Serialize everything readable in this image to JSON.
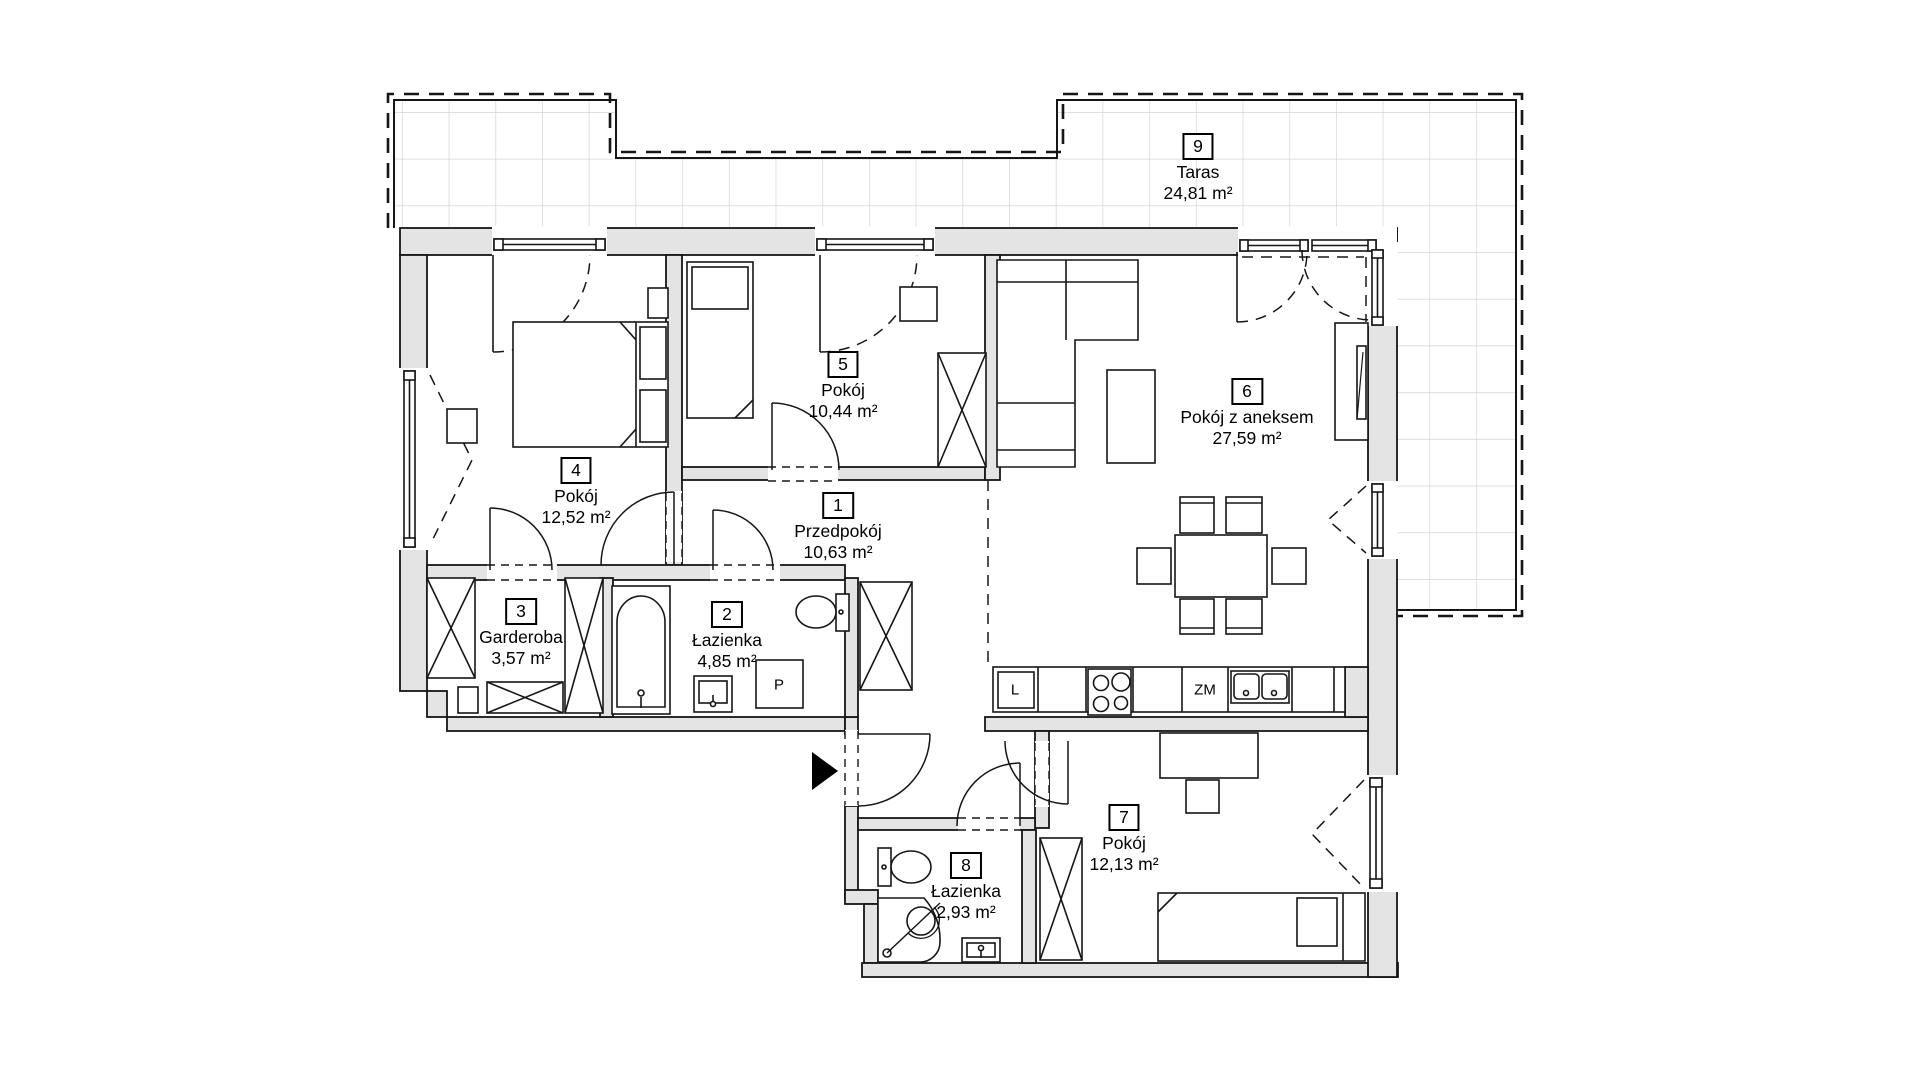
{
  "plan_title": "Rzut mieszkania",
  "rooms": [
    {
      "number": "1",
      "name": "Przedpokój",
      "area": "10,63 m²"
    },
    {
      "number": "2",
      "name": "Łazienka",
      "area": "4,85 m²"
    },
    {
      "number": "3",
      "name": "Garderoba",
      "area": "3,57 m²"
    },
    {
      "number": "4",
      "name": "Pokój",
      "area": "12,52 m²"
    },
    {
      "number": "5",
      "name": "Pokój",
      "area": "10,44 m²"
    },
    {
      "number": "6",
      "name": "Pokój z aneksem",
      "area": "27,59 m²"
    },
    {
      "number": "7",
      "name": "Pokój",
      "area": "12,13 m²"
    },
    {
      "number": "8",
      "name": "Łazienka",
      "area": "2,93 m²"
    },
    {
      "number": "9",
      "name": "Taras",
      "area": "24,81 m²"
    }
  ],
  "appliances": {
    "fridge": "L",
    "dishwasher": "ZM",
    "washing_machine": "P"
  },
  "colors": {
    "wall_fill": "#e4e4e4",
    "line": "#161616",
    "tile_line": "#d4d4d4"
  }
}
